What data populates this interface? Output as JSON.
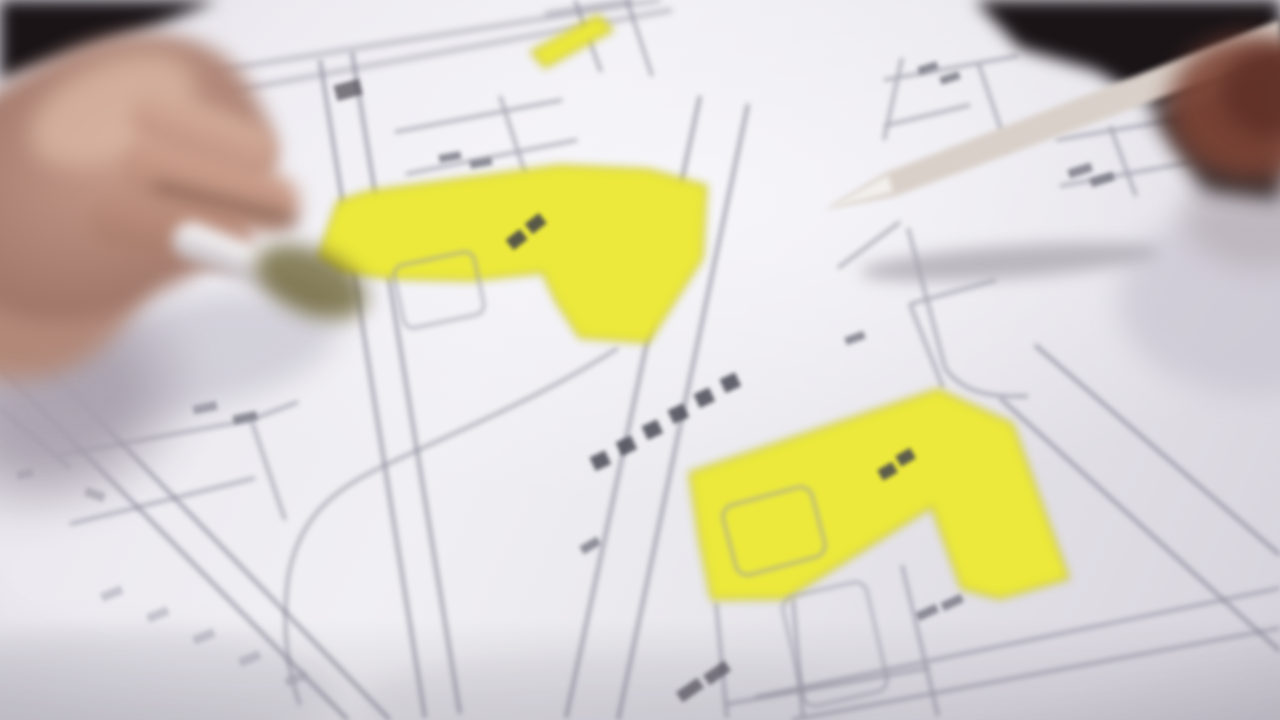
{
  "scene": {
    "type": "photograph",
    "setting": "out-of-focus close-up of a cadastral parcel map being discussed at a table",
    "description": "Blurred video still: a left hand holding a pale pen enters from the left and a beige pen held from the top-right corner points at a white cadastral map; two L-shaped parcels and a small sliver are highlighted in bright yellow; thin gray parcel boundary lines, rounded building outlines and rows of small illegible dark glyphs run along the roads; the top corners of the frame are dark background and a reddish blurred hand grips the right pen at the right edge.",
    "objects": {
      "map_document": "white cadastral map sheet with thin gray parcel boundary lines",
      "left_hand": "blurred hand entering from the left holding a pale pen",
      "left_pen": "pale pen whose tip rests beside the upper highlighted parcel",
      "right_pen": "beige pen entering from the top-right corner pointing at the map center",
      "right_hand": "blurred reddish hand at the right edge gripping the pen",
      "upper_parcel": "L-shaped parcel highlighted in yellow in the upper-left map area",
      "lower_parcel": "L-shaped parcel highlighted in yellow in the lower-right map area",
      "top_strip": "small yellow highlighted sliver near the top edge",
      "road_name_glyphs": "diagonal row of six dark illegible glyphs along a road",
      "parcel_labels": "small illegible dark marks inside each highlighted parcel",
      "building_outlines": "rounded rectangular building footprints drawn on the map"
    },
    "counts": {
      "highlighted_parcels": 2,
      "pens": 2,
      "hands": 2,
      "road_glyph_marks": 6
    },
    "legible_text": [],
    "colors": {
      "highlight_yellow": "#ece93c",
      "highlight_edge": "#c9c32c",
      "paper": "#e8e7ec",
      "map_line": "#8f8f9d",
      "glyph_dark": "#4b4b57",
      "background_dark": "#1a1417",
      "skin": "#c49a8a",
      "skin_shadow": "#9a7163",
      "sleeve": "#a19aa6",
      "pen_left": "#eceaec",
      "pen_right_body": "#d9d0c9",
      "pen_right_clip": "#3c3a40",
      "right_hand_red": "#7c4334",
      "shadow_olive": "#6b6233"
    }
  }
}
